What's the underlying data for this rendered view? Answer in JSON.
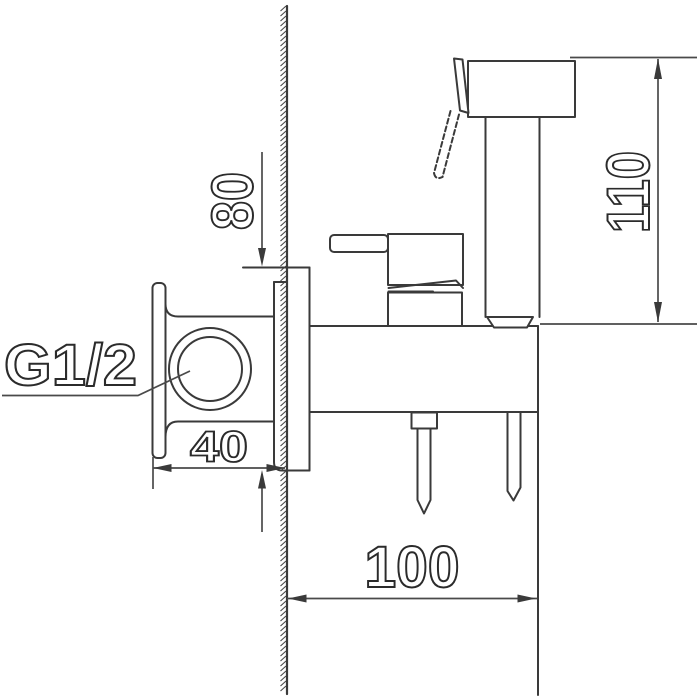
{
  "drawing": {
    "kind": "technical-dimension-drawing",
    "dimensions": {
      "offset_top": "80",
      "sprayer_height": "110",
      "thread": "G1/2",
      "body_width": "40",
      "holder_depth": "100"
    },
    "colors": {
      "line": "#3a3a3a",
      "dimension_line": "#4a4a4a",
      "text_outline": "#2b2b2b",
      "background": "#ffffff"
    }
  }
}
